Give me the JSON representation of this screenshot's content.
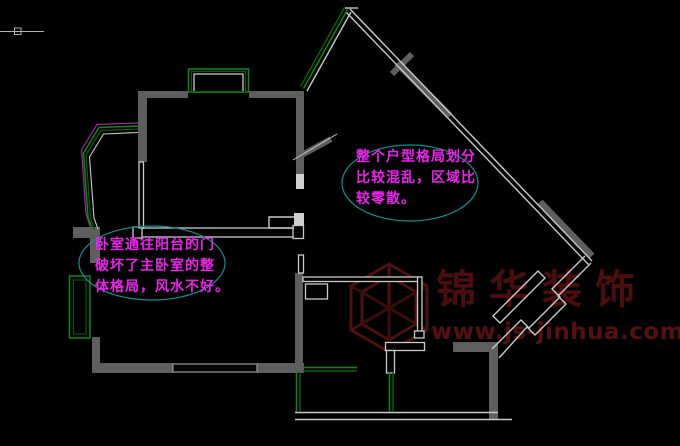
{
  "app": {
    "view": "CAD floor plan viewport",
    "background_color": "#000000"
  },
  "annotations": [
    {
      "id": "layout-note",
      "lines": [
        "整个户型格局划分",
        "比较混乱，区域比",
        "较零散。"
      ],
      "text_color": "#ee22ee",
      "bubble_color": "#0f9191"
    },
    {
      "id": "bedroom-note",
      "lines": [
        "卧室通往阳台的门",
        "破坏了主卧室的整",
        "体格局，风水不好。"
      ],
      "text_color": "#ee22ee",
      "bubble_color": "#0f9191"
    }
  ],
  "watermark": {
    "brand": "锦华装饰",
    "url": "www.js-jinhua.com",
    "brand_color": "#4d0d0d",
    "logo": "hexagon-cube-logo"
  },
  "colors": {
    "wall_gray": "#5e5e5e",
    "thin_line": "#c9c9c9",
    "window_green": "#0f8712",
    "window_green_dark": "#0a5c0a",
    "balcony_magenta": "#a224a2",
    "bubble_cyan": "#0f9191"
  }
}
